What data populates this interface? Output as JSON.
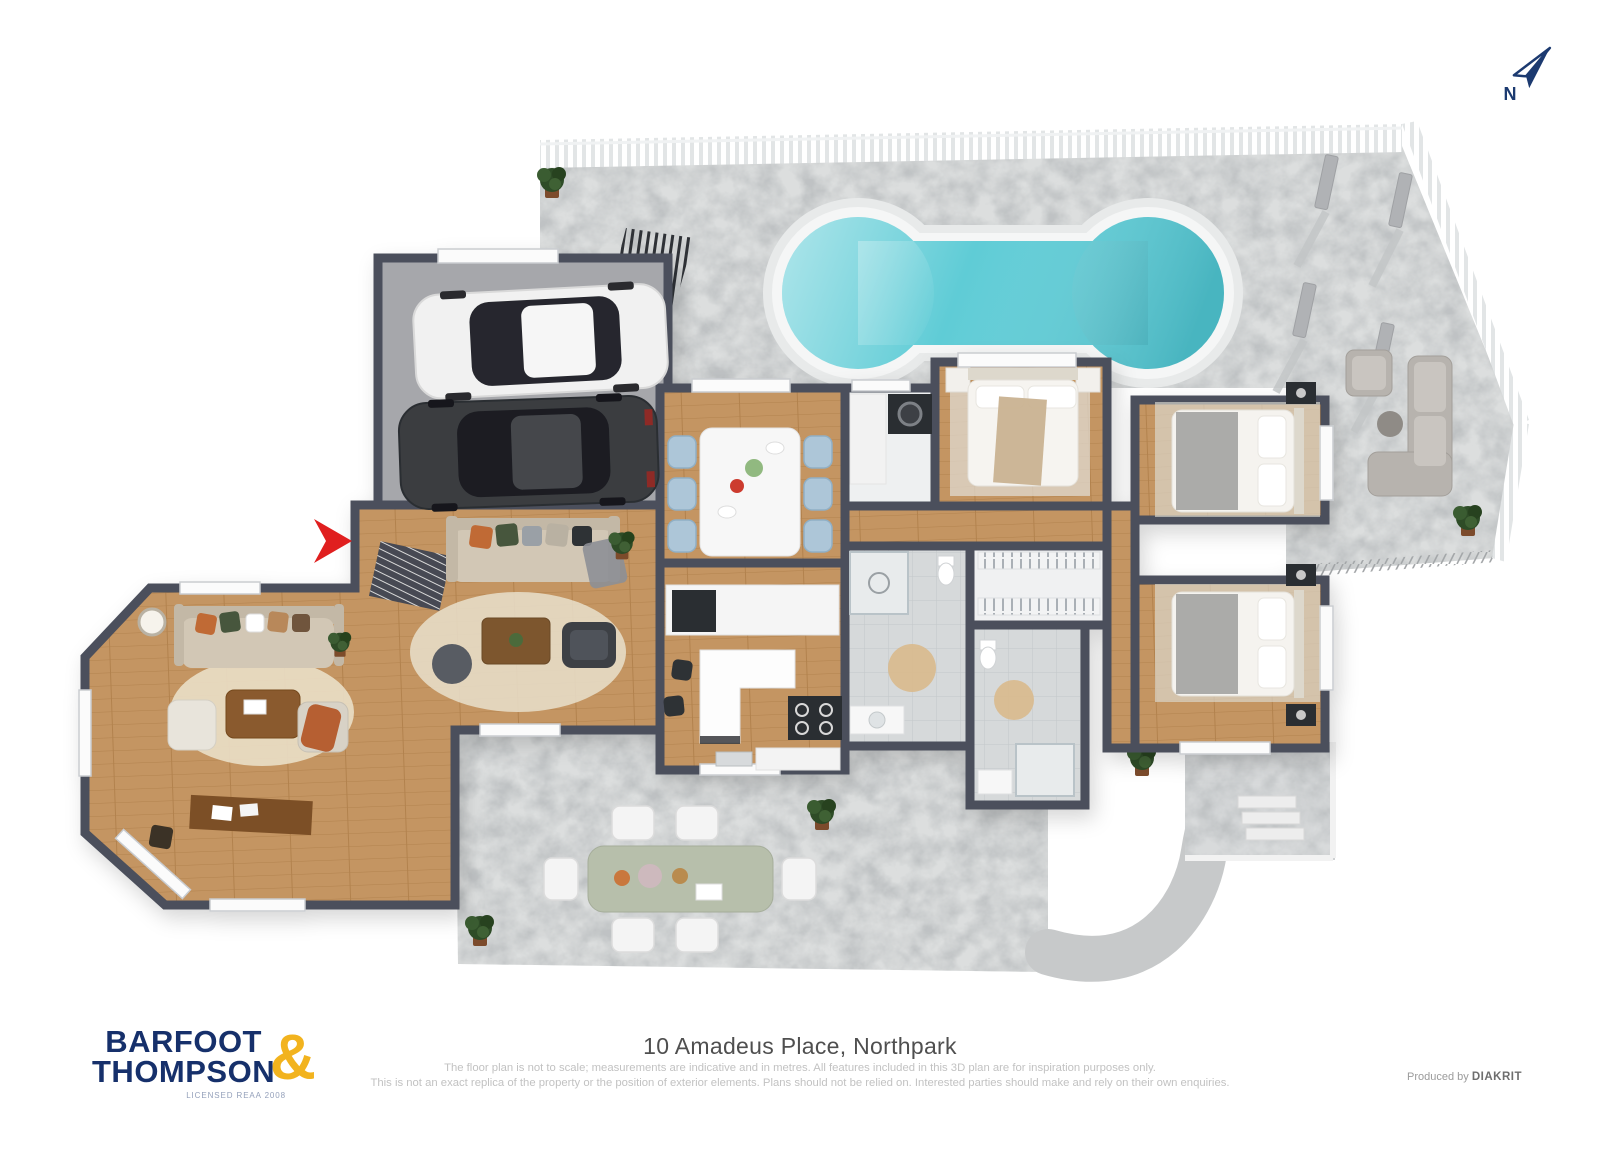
{
  "compass": {
    "label": "N"
  },
  "plan": {
    "colors": {
      "pool_water": "#5fccd6",
      "entrance_arrow": "#e01f1f",
      "wall": "#4c505c",
      "wood_floor": "#c49562",
      "concrete": "#dcdede"
    }
  },
  "footer": {
    "title": "10 Amadeus Place, Northpark",
    "disclaimer_line1": "The floor plan is not to scale; measurements are indicative and in metres. All features included in this 3D plan are for inspiration purposes only.",
    "disclaimer_line2": "This is not an exact replica of the property or the position of exterior elements. Plans should not be relied on. Interested parties should make and rely on their own enquiries.",
    "produced_by_label": "Produced by ",
    "producer_name": "DIAKRIT"
  },
  "logo": {
    "line1": "BARFOOT",
    "line2": "THOMPSON",
    "ampersand": "&",
    "tagline": "LICENSED REAA 2008"
  }
}
